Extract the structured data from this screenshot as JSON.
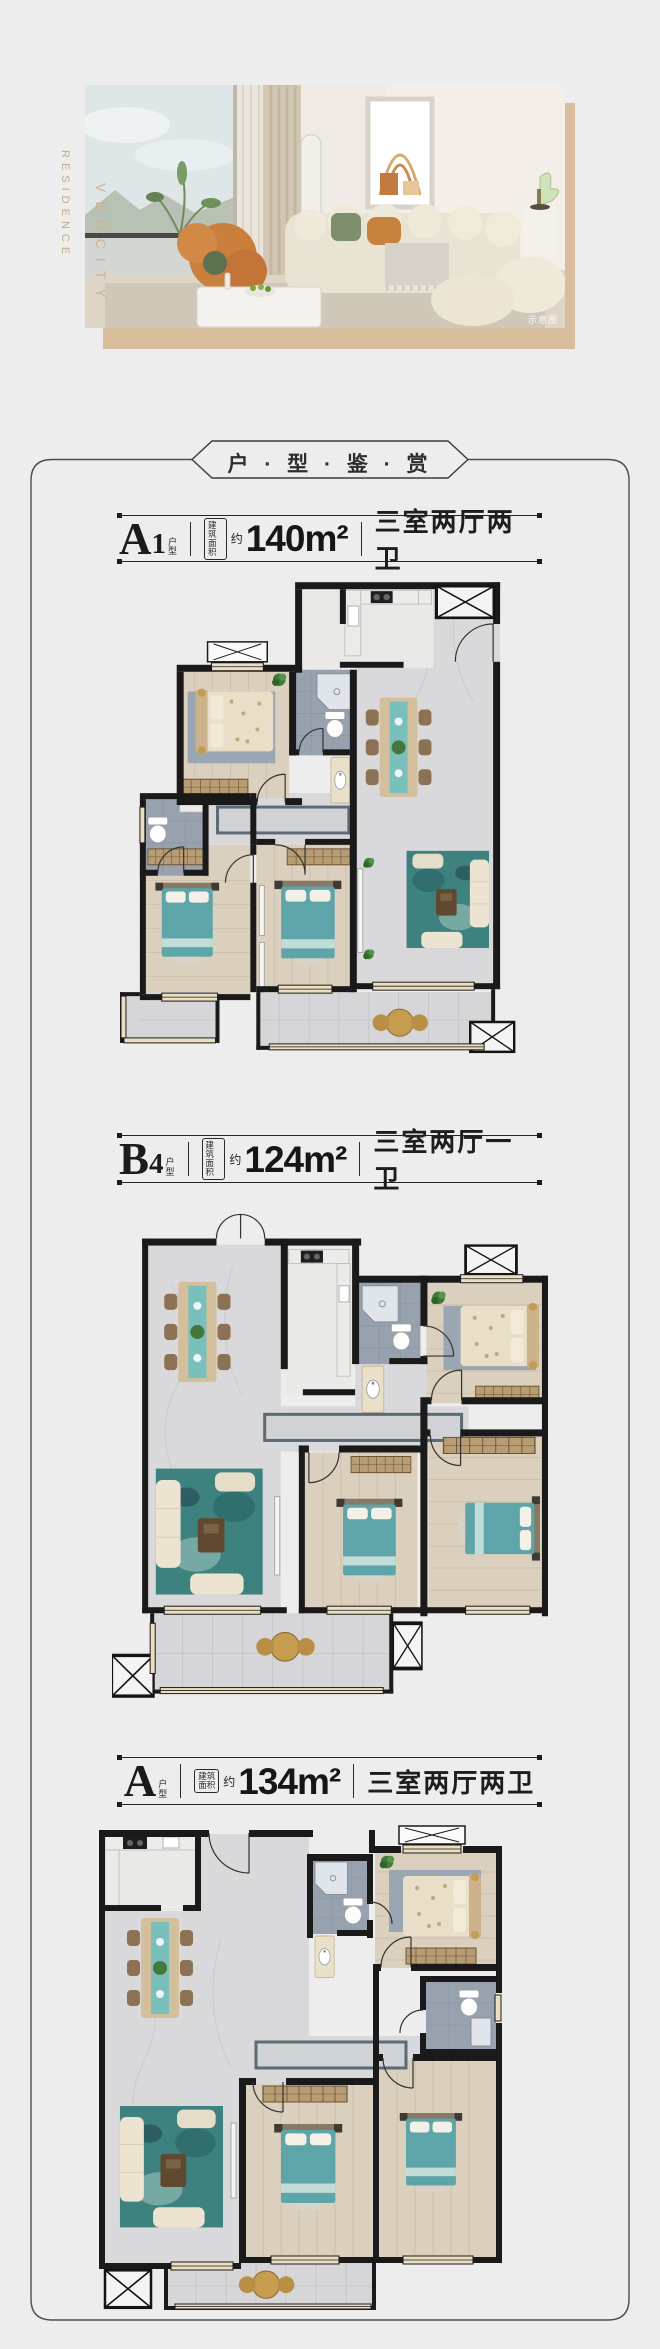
{
  "hero": {
    "vertical_text_primary": "RESIDENCE",
    "vertical_text_secondary": "VERCITY",
    "caption": "示意图"
  },
  "header": {
    "title": "户 · 型 · 鉴 · 赏"
  },
  "labels": {
    "unit_suffix_top": "户",
    "unit_suffix_bottom": "型",
    "area_box_top": "建筑",
    "area_box_bottom": "面积",
    "approx": "约"
  },
  "sections": [
    {
      "model_letter": "A",
      "model_number": "1",
      "area": "140m²",
      "rooms": "三室两厅两卫"
    },
    {
      "model_letter": "B",
      "model_number": "4",
      "area": "124m²",
      "rooms": "三室两厅一卫"
    },
    {
      "model_letter": "A",
      "model_number": "",
      "area": "134m²",
      "rooms": "三室两厅两卫"
    }
  ],
  "colors": {
    "accent_tan": "#d7bd9b",
    "bed_teal": "#5da5a9",
    "frame_line": "#4e4e4e",
    "wall": "#1a1a1a"
  }
}
